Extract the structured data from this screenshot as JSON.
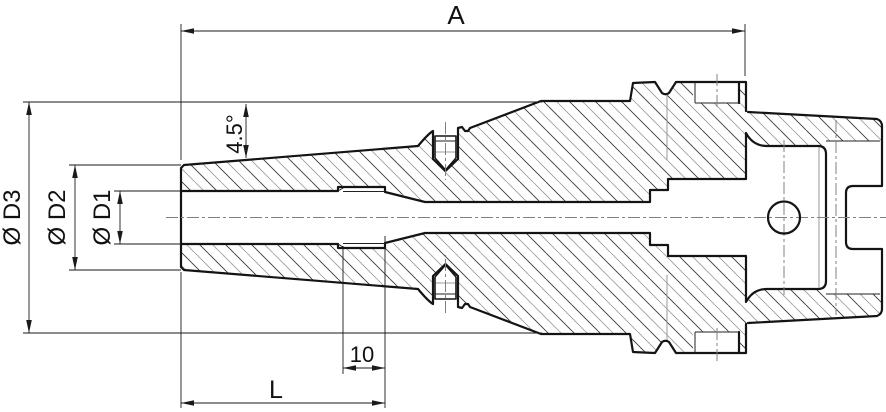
{
  "drawing": {
    "title": "tool-holder-section-drawing",
    "labels": {
      "length_A": "A",
      "dia_D3": "Ø D3",
      "dia_D2": "Ø D2",
      "dia_D1": "Ø D1",
      "taper_angle": "4.5°",
      "thread_length": "10",
      "clamp_length": "L"
    },
    "colors": {
      "outline": "#141414",
      "thin": "#222222",
      "grey": "#999999",
      "dimension": "#1a1a1a",
      "centerline": "#808080",
      "hatch_dark": "#3a3a3a",
      "hatch_light": "#9a9a9a",
      "background": "#ffffff"
    }
  }
}
